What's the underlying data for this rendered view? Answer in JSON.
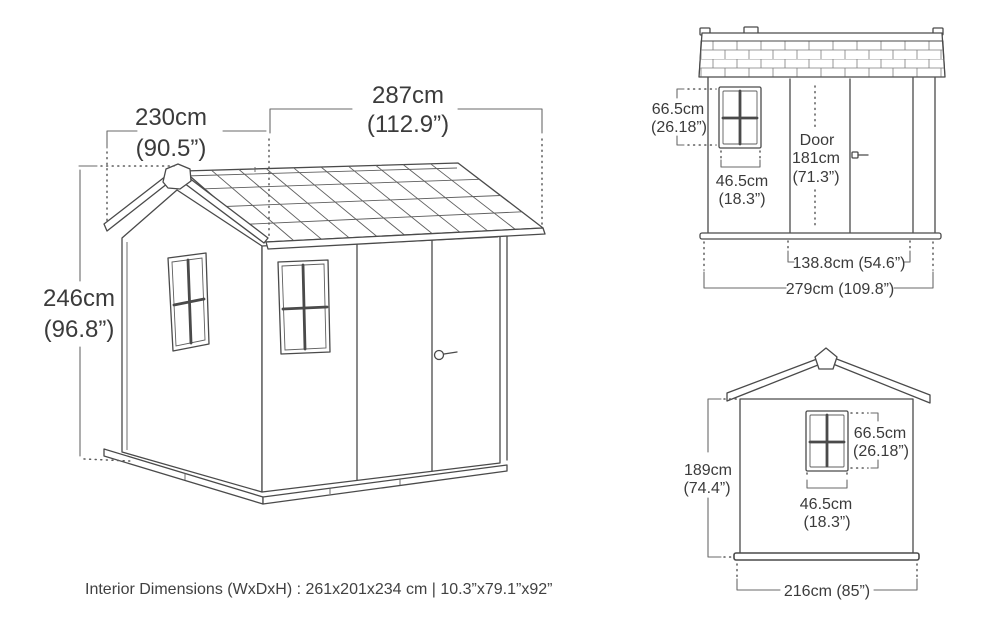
{
  "colors": {
    "background": "#ffffff",
    "line": "#4a4a4a",
    "dim_line": "#6a6a6a",
    "text": "#3b3b3b"
  },
  "views": {
    "perspective": {
      "width": {
        "cm": "287cm",
        "inch": "(112.9”)"
      },
      "depth": {
        "cm": "230cm",
        "inch": "(90.5”)"
      },
      "height": {
        "cm": "246cm",
        "inch": "(96.8”)"
      }
    },
    "door_side": {
      "window_height": {
        "cm": "66.5cm",
        "inch": "(26.18”)"
      },
      "window_width": {
        "cm": "46.5cm",
        "inch": "(18.3”)"
      },
      "door": {
        "label": "Door",
        "cm": "181cm",
        "inch": "(71.3”)"
      },
      "door_opening_width": "138.8cm (54.6”)",
      "overall_width": "279cm (109.8”)"
    },
    "gable_front": {
      "wall_height": {
        "cm": "189cm",
        "inch": "(74.4”)"
      },
      "window_height": {
        "cm": "66.5cm",
        "inch": "(26.18”)"
      },
      "window_width": {
        "cm": "46.5cm",
        "inch": "(18.3”)"
      },
      "overall_width": "216cm (85”)"
    }
  },
  "footer": {
    "interior_dimensions": "Interior Dimensions (WxDxH) : 261x201x234 cm | 10.3”x79.1”x92”"
  }
}
